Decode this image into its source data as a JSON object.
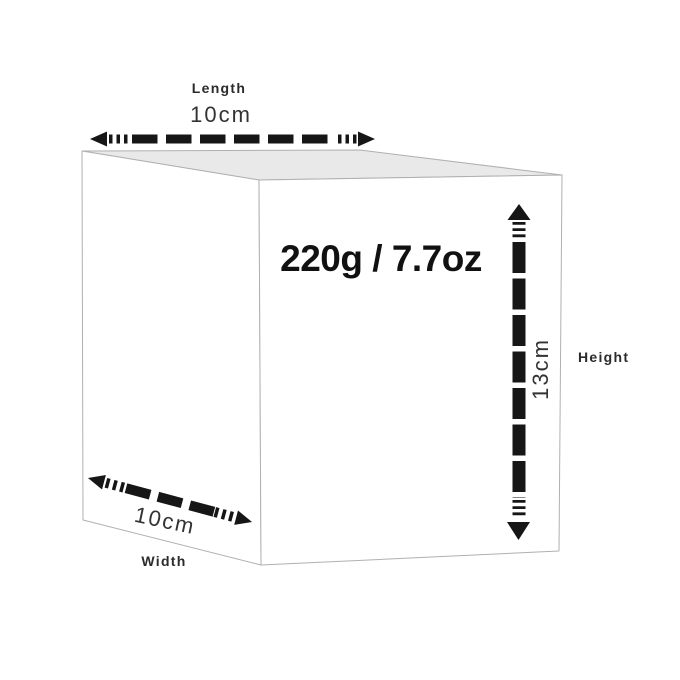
{
  "diagram": {
    "weight": "220g / 7.7oz",
    "dimensions": {
      "length": {
        "label": "Length",
        "value": "10cm"
      },
      "width": {
        "label": "Width",
        "value": "10cm"
      },
      "height": {
        "label": "Height",
        "value": "13cm"
      }
    }
  },
  "colors": {
    "background": "#ffffff",
    "box_top_face": "#e9e9e9",
    "box_left_face": "#ffffff",
    "box_front_face": "#ffffff",
    "box_edge": "#b0b0b0",
    "arrow": "#161616",
    "label_text": "#2b2b2b",
    "value_text": "#333333",
    "weight_text": "#111111"
  }
}
